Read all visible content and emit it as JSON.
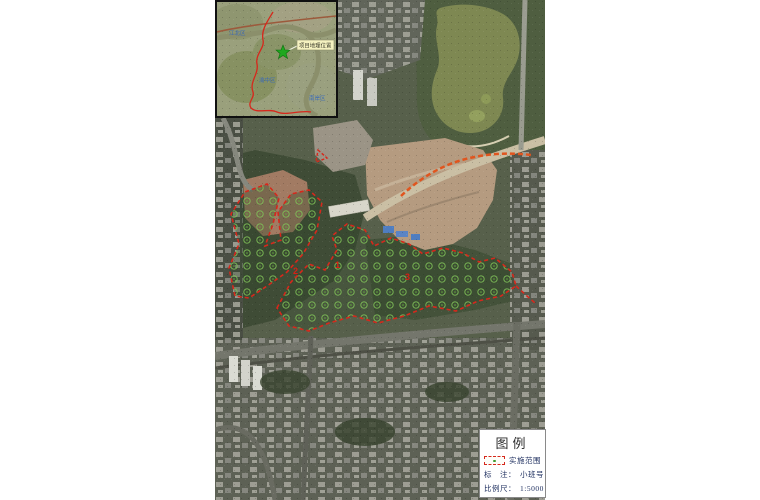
{
  "inset": {
    "callout_label": "项目地理位置",
    "place_labels": [
      "江北区",
      "渝中区",
      "南岸区"
    ]
  },
  "map": {
    "compartment_numbers": [
      "2",
      "1",
      "3"
    ]
  },
  "legend": {
    "title": "图例",
    "scope_label": "实施范围",
    "annotation_label": "标　注：",
    "annotation_value": "小班号",
    "scale_label": "比例尺：",
    "scale_value": "1:5000"
  },
  "colors": {
    "boundary_red": "#d6281c",
    "tree_green": "#7fc257",
    "star_green": "#1fa81f",
    "callout_yellow": "#f5f2c0"
  }
}
